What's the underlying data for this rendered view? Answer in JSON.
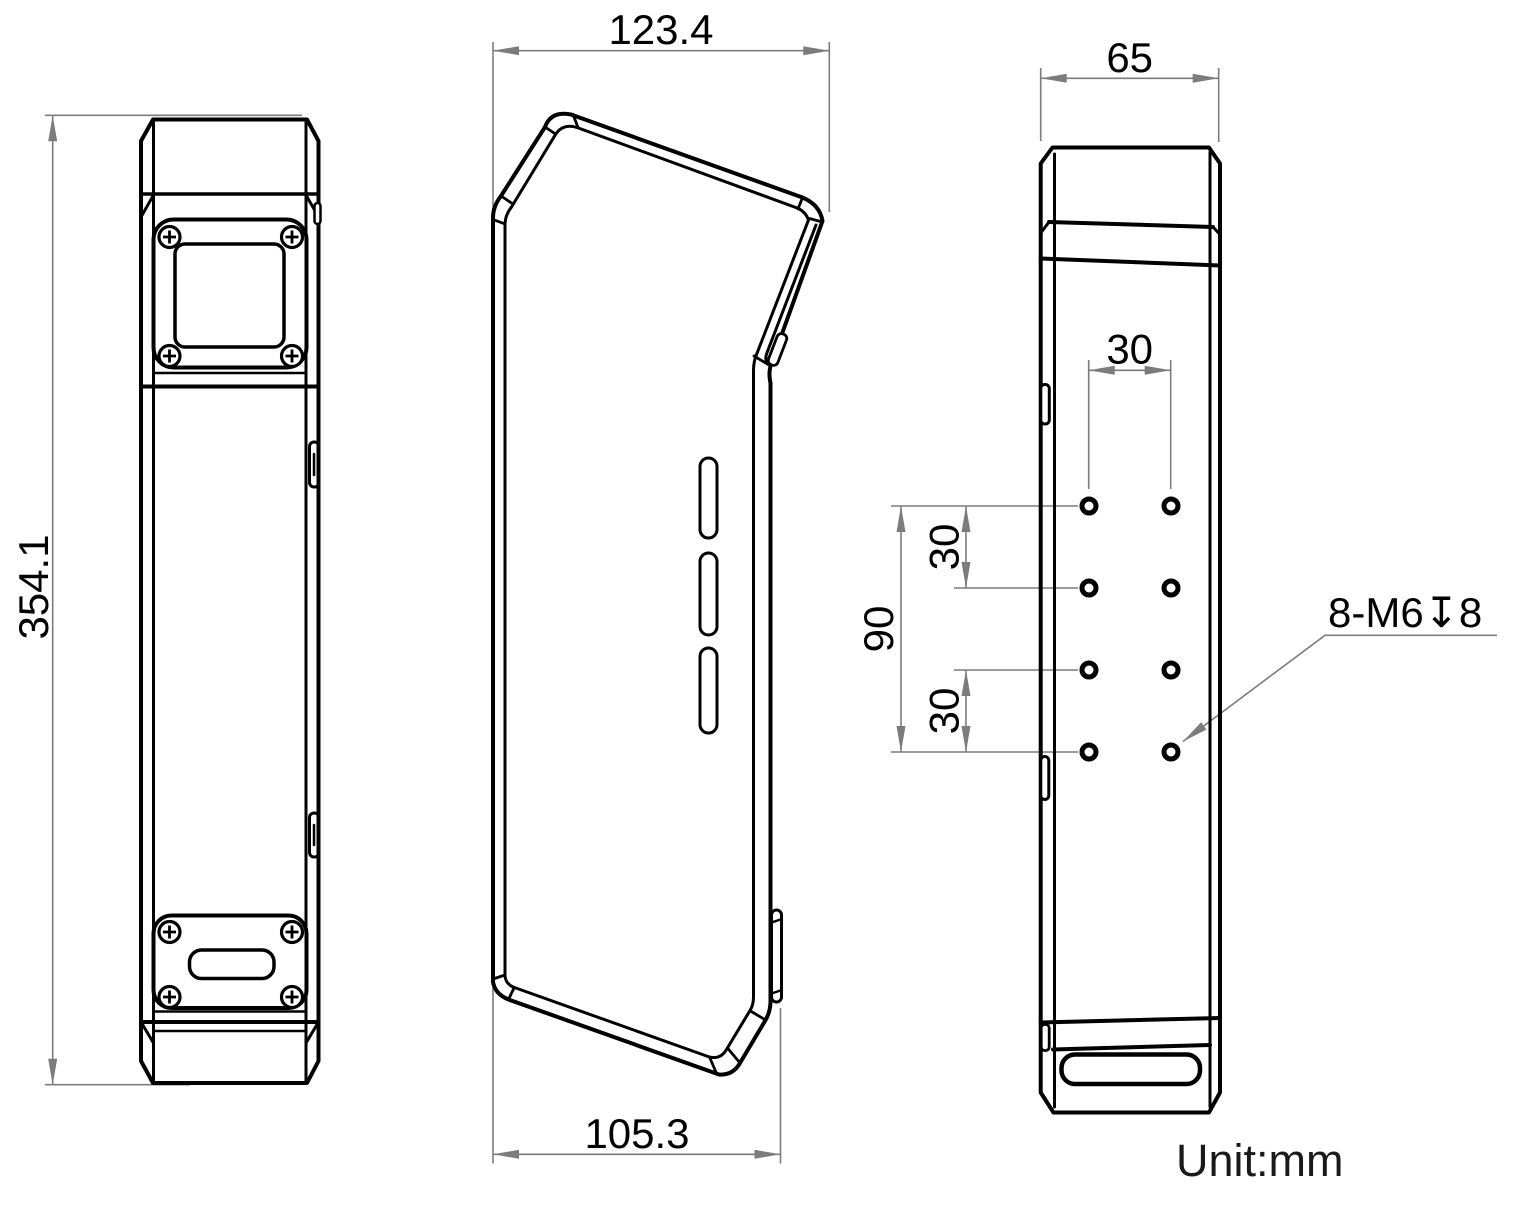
{
  "drawing": {
    "unit_note": "Unit:mm",
    "front_view": {
      "height": "354.1"
    },
    "side_view": {
      "top_width": "123.4",
      "bottom_width": "105.3"
    },
    "back_view": {
      "width": "65",
      "hole_column_spacing": "30",
      "hole_row_span": "90",
      "hole_row_spacing_upper": "30",
      "hole_row_spacing_lower": "30",
      "thread_callout": "8-M6↧8"
    }
  }
}
